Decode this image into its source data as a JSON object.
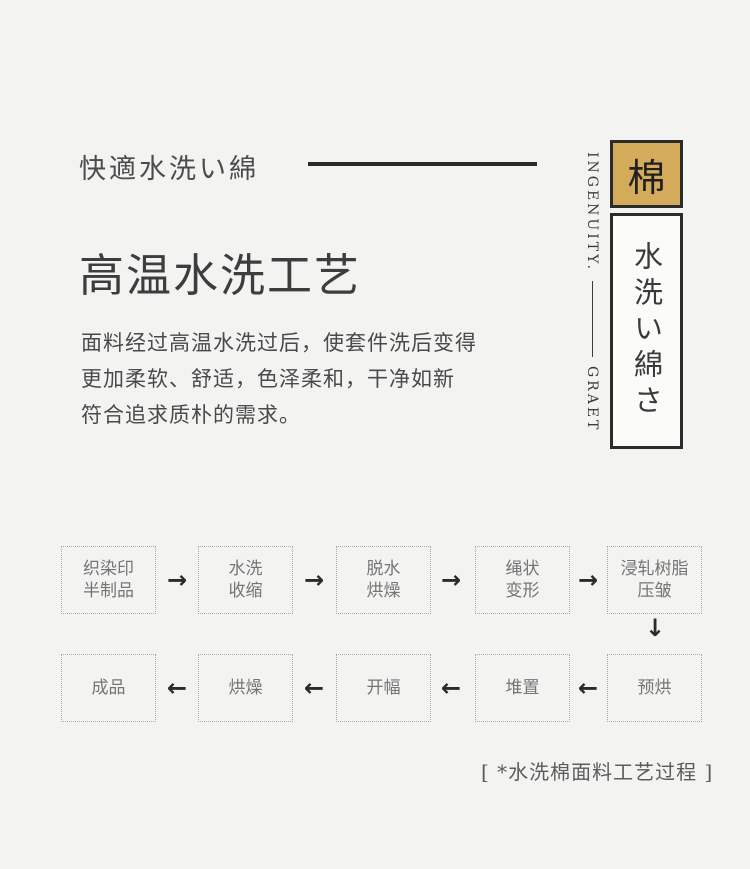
{
  "colors": {
    "background": "#f3f3f2",
    "badge_gold": "#d4ab5a",
    "border_dark": "#2b2b2b",
    "text_primary": "#3d3d3d",
    "flow_text": "#757575"
  },
  "header": {
    "subtitle": "快適水洗い綿",
    "title": "高温水洗工艺",
    "paragraph_lines": [
      "面料经过高温水洗过后，使套件洗后变得",
      "更加柔软、舒适，色泽柔和，干净如新",
      "符合追求质朴的需求。"
    ]
  },
  "side_panel": {
    "vertical_caption_top": "INGENUITY.",
    "vertical_caption_bottom": "GRAET",
    "badge_char": "棉",
    "vertical_title": "水洗い綿さ"
  },
  "flowchart": {
    "row1": [
      {
        "lines": [
          "织染印",
          "半制品"
        ]
      },
      {
        "lines": [
          "水洗",
          "收缩"
        ]
      },
      {
        "lines": [
          "脱水",
          "烘燥"
        ]
      },
      {
        "lines": [
          "绳状",
          "变形"
        ]
      },
      {
        "lines": [
          "浸轧树脂",
          "压皱"
        ]
      }
    ],
    "row2": [
      {
        "lines": [
          "成品"
        ]
      },
      {
        "lines": [
          "烘燥"
        ]
      },
      {
        "lines": [
          "开幅"
        ]
      },
      {
        "lines": [
          "堆置"
        ]
      },
      {
        "lines": [
          "预烘"
        ]
      }
    ],
    "arrow_right": "→",
    "arrow_left": "←",
    "arrow_down": "↓",
    "caption": "[ *水洗棉面料工艺过程 ]"
  }
}
